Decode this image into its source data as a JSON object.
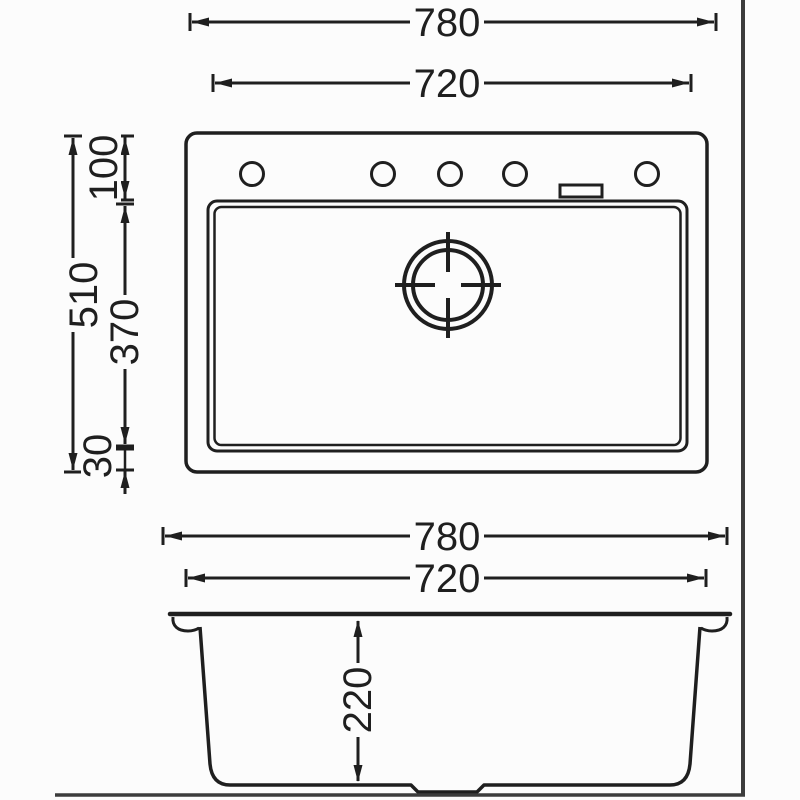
{
  "drawing_type": "sink-dimension-diagram",
  "colors": {
    "line": "#1f1f1f",
    "frame": "#3c3c3c",
    "background": "#fcfcfc"
  },
  "top_view": {
    "dim_780": "780",
    "dim_720": "720",
    "dim_510": "510",
    "dim_100": "100",
    "dim_370": "370",
    "dim_30": "30",
    "faucet_hole_count": 5,
    "icons": {
      "drain": "drain-crosshair",
      "faucet_hole": "circle",
      "accessory_slot": "rectangle"
    }
  },
  "section_view": {
    "dim_780": "780",
    "dim_720": "720",
    "dim_220": "220"
  }
}
